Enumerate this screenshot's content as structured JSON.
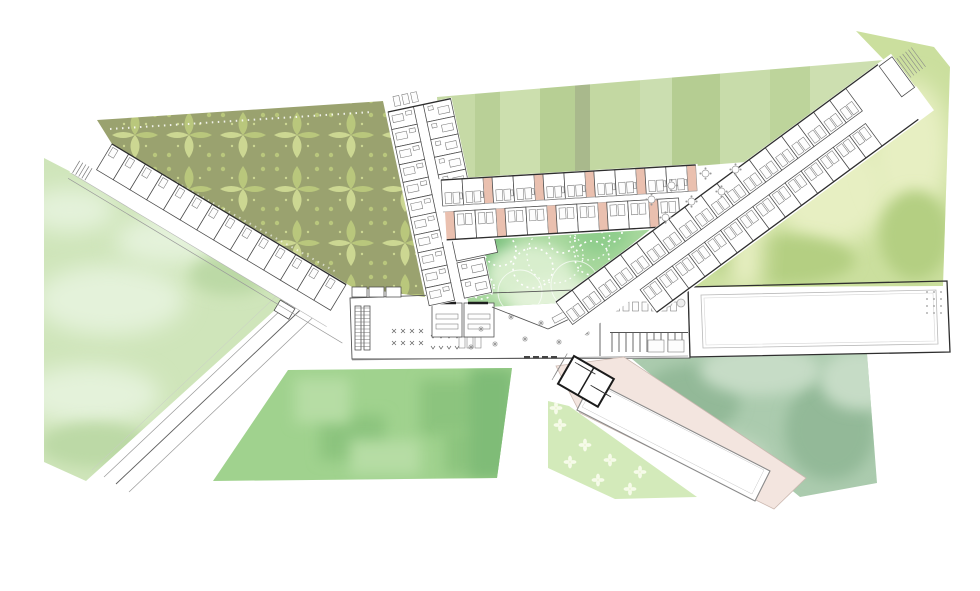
{
  "drawing": {
    "kind": "architectural-site-plan",
    "zones": [
      {
        "name": "ornamental-damask-garden"
      },
      {
        "name": "striped-lawn-field"
      },
      {
        "name": "east-watercolor-grove"
      },
      {
        "name": "west-meadow"
      },
      {
        "name": "south-lawn-terrace"
      },
      {
        "name": "inner-courtyard"
      },
      {
        "name": "flower-meadow-patch"
      },
      {
        "name": "pool-garden"
      },
      {
        "name": "swimming-pool"
      }
    ]
  },
  "colors": {
    "background": "#ffffff",
    "wall_dark": "#2e2e2e",
    "wall_mid": "#555555",
    "line_light": "#9a9a9a",
    "damask_base": "#9aa26f",
    "damask_motif": "#b9c77c",
    "damask_motif_light": "#ccd792",
    "stripes": [
      "#c6daa6",
      "#b9d097",
      "#ccdfae",
      "#b7cf94",
      "#a9b98c",
      "#c3d8a2",
      "#cbdeb0",
      "#b5cd92",
      "#c8dcaa",
      "#bdd49b",
      "#cddfb0"
    ],
    "watercolor_base": "#cbdf9e",
    "watercolor_light": "#e7efc2",
    "watercolor_dark": "#b4cf82",
    "watercolor_yellow": "#e6eeb4",
    "meadow_base": "#cfe5ba",
    "meadow_light": "#e4f2da",
    "meadow_dark": "#bcd9a6",
    "lawn_base": "#a0d28e",
    "lawn_dark": "#8cc47e",
    "lawn_light": "#b6dda4",
    "courtyard_base": "#a6d79c",
    "courtyard_dark": "#7cc17e",
    "courtyard_mid": "#8fcd8c",
    "courtyard_light": "#d8eecd",
    "floral_base": "#d3eaba",
    "floral_motif": "#f6fbe9",
    "seafoam_base": "#abcbae",
    "seafoam_dark": "#93b998",
    "seafoam_light": "#c6dcc6",
    "deck_pink": "#f3e5df",
    "loggia_pink": "#eac0af",
    "pool_fill": "#ffffff",
    "pool_edge": "#8a8a8a"
  },
  "buildings": {
    "left_wing": {
      "room_count": 14,
      "steps": 5
    },
    "vertical_wing": {
      "rows_left": 11,
      "rows_right_upper": 6,
      "rows_right_lower": 2,
      "cap_dashes": 3
    },
    "room_rows": {
      "upper_units": 5,
      "lower_units": 4
    },
    "diagonal_wing": {
      "rooms_nw": 18,
      "rooms_se": 14,
      "terrace_dashes": 6
    },
    "hall": {
      "dot_rows": 4
    },
    "services": {
      "wc_stalls": 11,
      "fixtures": 8,
      "entry_dashes": 4
    },
    "library": {
      "shelf_lines": 12,
      "chairs_per_row": 4,
      "bench_per_row": 4,
      "tables": 3,
      "storage_cells": 3
    },
    "pool_house": {
      "rungs": 5,
      "steps": 6
    }
  }
}
